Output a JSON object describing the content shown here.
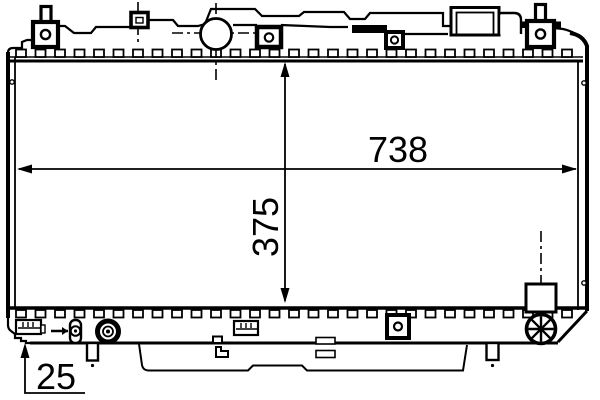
{
  "drawing": {
    "kind": "radiator-technical-line-drawing",
    "colors": {
      "line": "#000000",
      "background": "#ffffff"
    },
    "dimensions": {
      "core_width": "738",
      "core_height": "375",
      "tank_offset": "25"
    }
  }
}
